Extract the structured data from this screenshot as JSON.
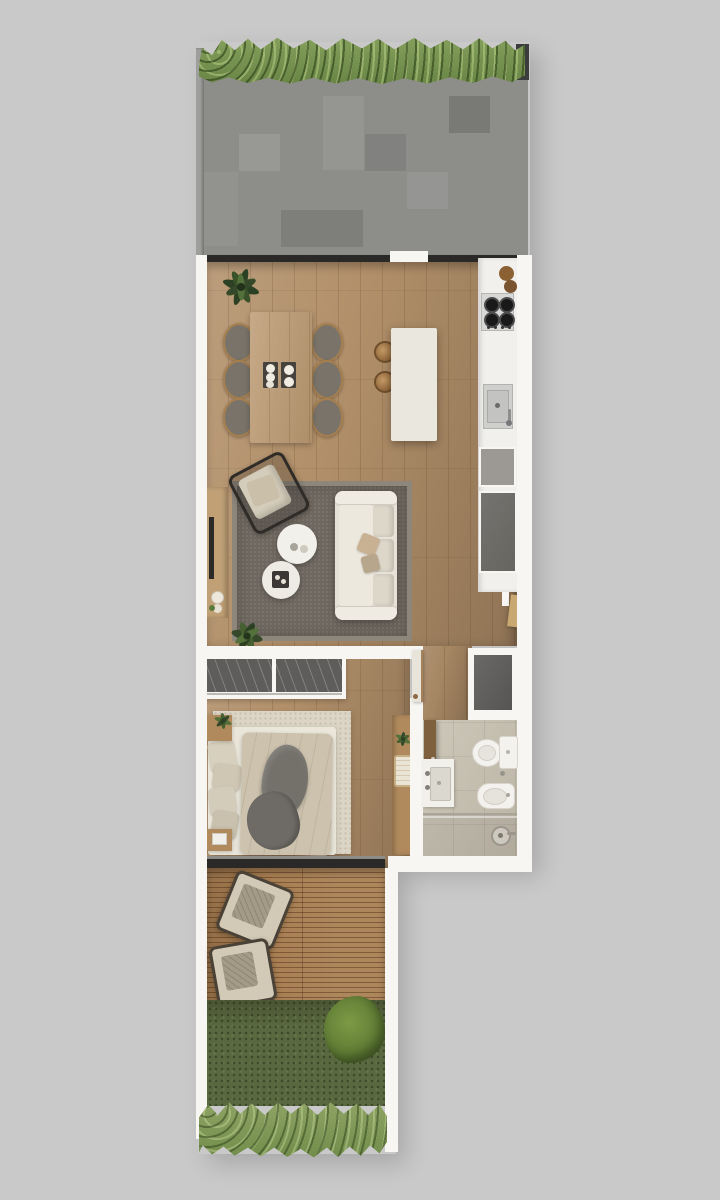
{
  "meta": {
    "type": "architectural-floor-plan-render",
    "view": "top-down",
    "canvas": {
      "width": 720,
      "height": 1200
    },
    "visible_text": "none"
  },
  "colors": {
    "bg": "#c9c9c9",
    "wall": "#f7f6f3",
    "band": "#2b2927",
    "wood": "#b2906a",
    "deck": "#a87e52",
    "stone-light": "#a3a2a0",
    "stone-dark": "#45494b",
    "hedge": "#76914e",
    "shrub": "#879c60",
    "lawn": "#59683f",
    "bush": "#6d8838",
    "counter": "#f1f0ec",
    "steel": "#d8d8d6",
    "burner": "#191919",
    "cab-light": "#9c9995",
    "cab-dark": "#6f6d69",
    "island": "#eae7de",
    "table-wood": "#bd9b73",
    "chair": "#797369",
    "chair-frame": "#a57f50",
    "mat": "#45423e",
    "rug": "#6f6860",
    "rug-border": "#8d867b",
    "sofa": "#e7e2d8",
    "cushion": "#ddd7ca",
    "tray": "#3b3835",
    "console": "#c1a076",
    "tv": "#2c2a27",
    "wardrobe": "#5e5d5b",
    "bedrug": "#dcd5c6",
    "sheet": "#eae6da",
    "duvet": "#cdc2ae",
    "blanket": "#74716b",
    "pillow": "#d5cdbb",
    "nightstand": "#b08a5c",
    "desk": "#b08a5d",
    "bath-floor": "#c7c0b0",
    "fixture": "#f4f2ee",
    "fixture-edge": "#d8d4cc",
    "door-wood": "#7e5f3e",
    "plant-dark": "#2c4123",
    "plant-mid": "#466031",
    "plant-light": "#5d7a3d"
  },
  "plan": {
    "rooms": [
      {
        "id": "terrace",
        "features": [
          "hedge",
          "stone-paving",
          "sliding-glass-door"
        ]
      },
      {
        "id": "living-dining",
        "features": [
          "plant",
          "dining-table",
          "six-chairs",
          "two-placemats",
          "tv-console",
          "tv",
          "area-rug",
          "armchair",
          "sofa",
          "two-round-coffee-tables",
          "tray",
          "floor-plant"
        ]
      },
      {
        "id": "kitchen",
        "features": [
          "island",
          "two-stools",
          "cutting-board",
          "cooktop",
          "sink",
          "tall-cabinet",
          "fridge-cabinet",
          "entrance-door"
        ]
      },
      {
        "id": "hallway",
        "features": [
          "closet",
          "bedroom-door"
        ]
      },
      {
        "id": "bedroom",
        "features": [
          "sliding-wardrobe",
          "double-bed",
          "pillows",
          "duvet",
          "blanket",
          "two-nightstands",
          "plant",
          "desk",
          "basket",
          "sliding-glass-door"
        ]
      },
      {
        "id": "bathroom",
        "features": [
          "door",
          "washbasin",
          "toilet",
          "bidet",
          "shower",
          "shower-head",
          "glass-screen"
        ]
      },
      {
        "id": "deck",
        "features": [
          "wood-planks",
          "two-loungers"
        ]
      },
      {
        "id": "garden",
        "features": [
          "lawn",
          "bush",
          "shrub-border"
        ]
      }
    ]
  }
}
